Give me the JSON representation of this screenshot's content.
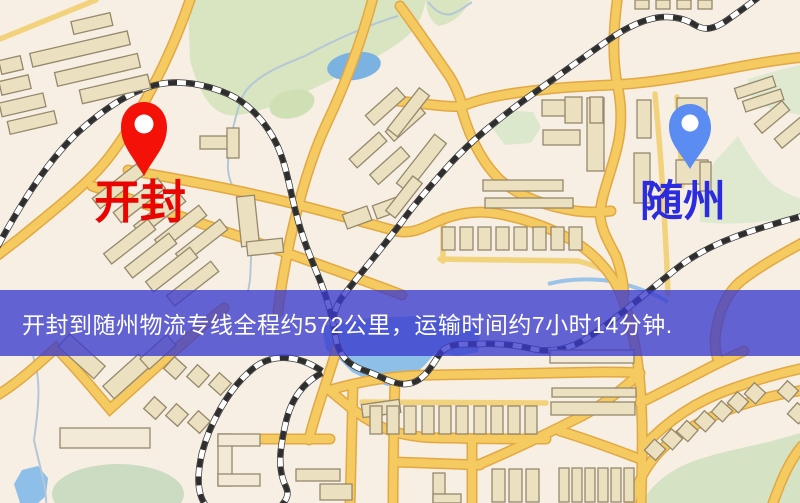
{
  "map": {
    "type": "road-map",
    "markers": [
      {
        "name": "origin",
        "icon": "map-pin-icon",
        "label": "开封",
        "label_color": "#e80502",
        "pin_color": "#f31108"
      },
      {
        "name": "destination",
        "icon": "map-pin-icon",
        "label": "随州",
        "label_color": "#2b2be0",
        "pin_color": "#5b8cf2"
      }
    ],
    "banner": {
      "text": "开封到随州物流专线全程约572公里，运输时间约7小时14分钟.",
      "origin": "开封",
      "destination": "随州",
      "distance_km": "572",
      "duration": "7小时14分钟",
      "background": "#3c3ccd",
      "text_color": "#ffffff"
    }
  }
}
